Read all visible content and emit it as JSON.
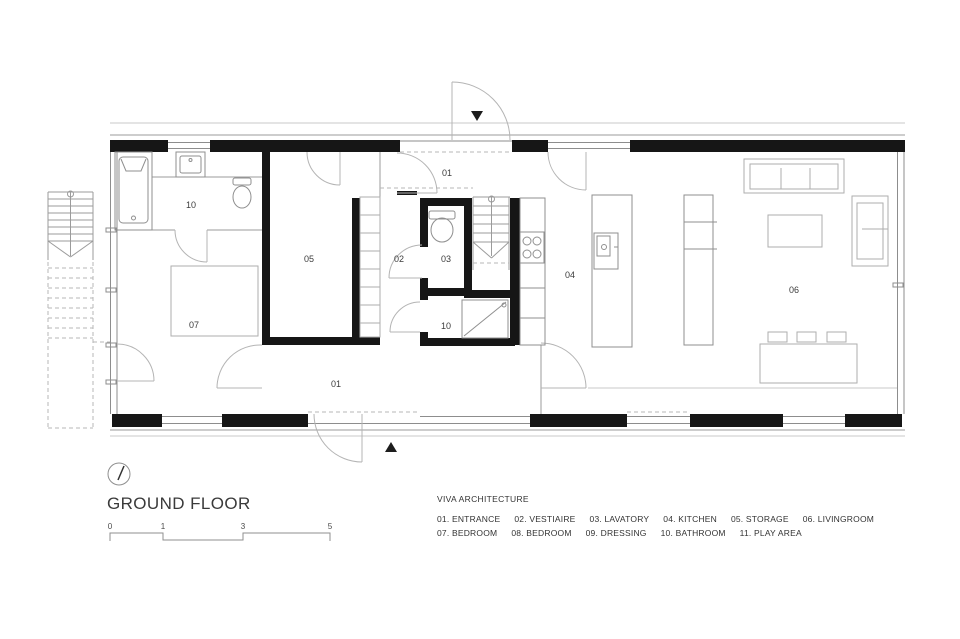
{
  "title": "GROUND FLOOR",
  "firm": "VIVA ARCHITECTURE",
  "rooms": {
    "entrance_hall": "01",
    "entrance_corridor": "01",
    "vestiaire": "02",
    "lavatory": "03",
    "kitchen": "04",
    "storage": "05",
    "livingroom": "06",
    "bedroom": "07",
    "bathroom_upper": "10",
    "bathroom_lower": "10"
  },
  "scale": {
    "labels": [
      "0",
      "1",
      "3",
      "5"
    ]
  },
  "legend": {
    "row1": [
      "01. ENTRANCE",
      "02. VESTIAIRE",
      "03. LAVATORY",
      "04. KITCHEN",
      "05. STORAGE",
      "06. LIVINGROOM"
    ],
    "row2": [
      "07. BEDROOM",
      "08. BEDROOM",
      "09. DRESSING",
      "10. BATHROOM",
      "11. PLAY AREA"
    ]
  },
  "colors": {
    "wall": "#161616",
    "line": "#9b9b9b",
    "text": "#3a3a3a"
  }
}
